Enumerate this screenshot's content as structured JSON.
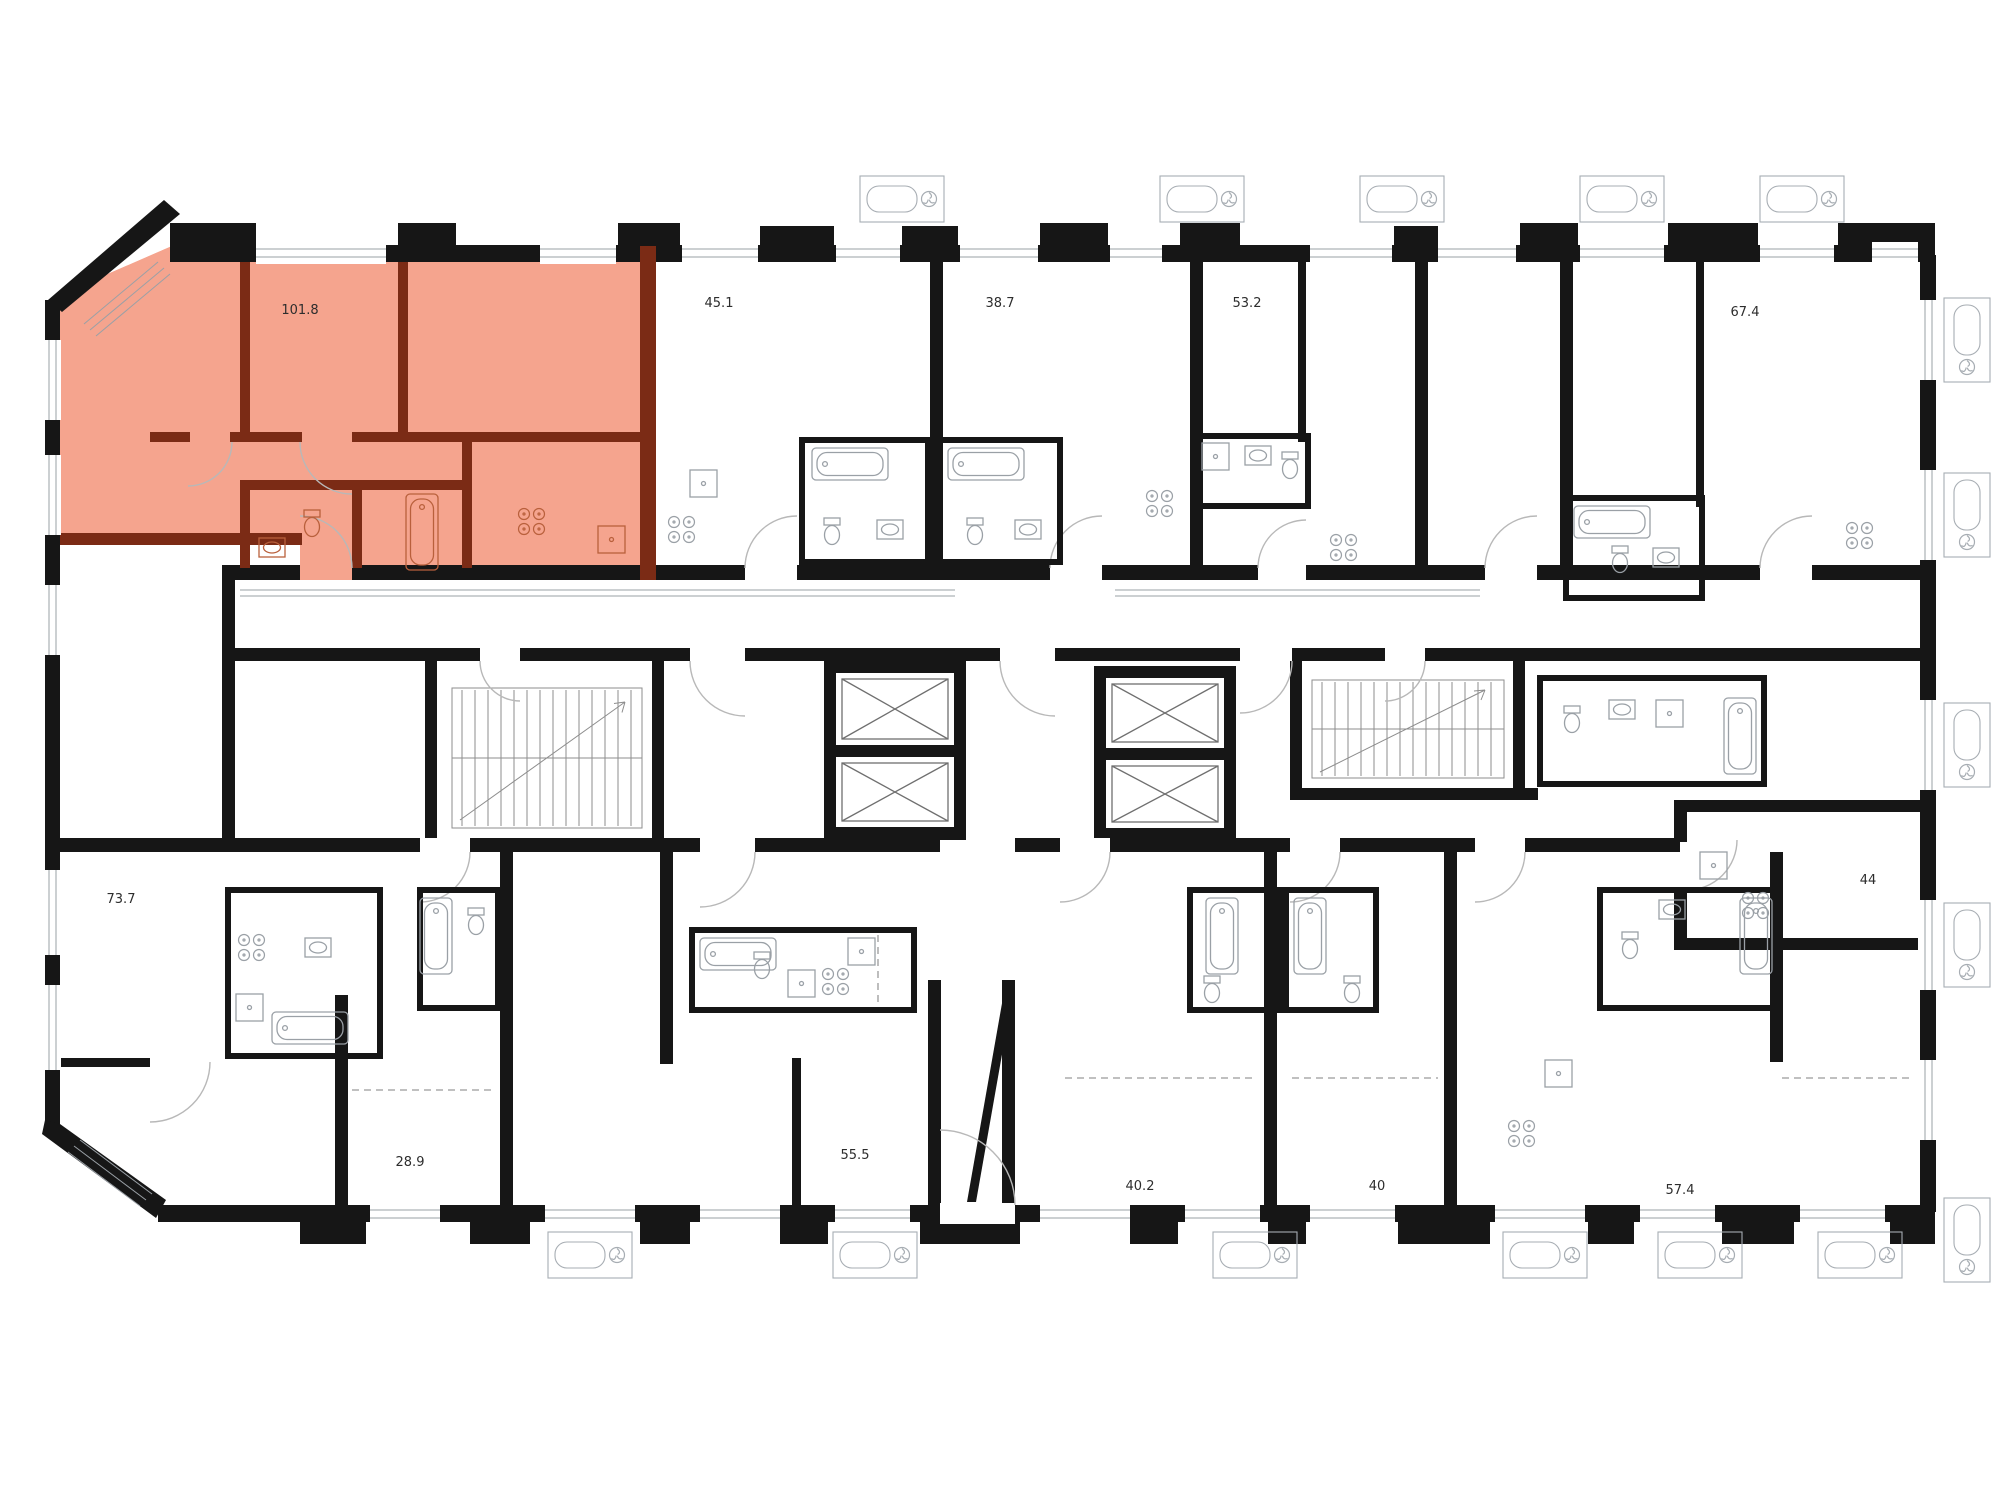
{
  "plan": {
    "type": "residential-floor-plan",
    "highlight": {
      "fill": "#f5a48e",
      "wall": "#7b2b15",
      "selected_unit_area": "101.8"
    },
    "colors": {
      "wall": "#161616",
      "fixture": "#9aa0a6",
      "background": "#ffffff"
    },
    "units": [
      {
        "id": "unit-101-8",
        "area": "101.8",
        "highlighted": true
      },
      {
        "id": "unit-45-1",
        "area": "45.1",
        "highlighted": false
      },
      {
        "id": "unit-38-7",
        "area": "38.7",
        "highlighted": false
      },
      {
        "id": "unit-53-2",
        "area": "53.2",
        "highlighted": false
      },
      {
        "id": "unit-67-4",
        "area": "67.4",
        "highlighted": false
      },
      {
        "id": "unit-73-7",
        "area": "73.7",
        "highlighted": false
      },
      {
        "id": "unit-44",
        "area": "44",
        "highlighted": false
      },
      {
        "id": "unit-28-9",
        "area": "28.9",
        "highlighted": false
      },
      {
        "id": "unit-55-5",
        "area": "55.5",
        "highlighted": false
      },
      {
        "id": "unit-40-2",
        "area": "40.2",
        "highlighted": false
      },
      {
        "id": "unit-40",
        "area": "40",
        "highlighted": false
      },
      {
        "id": "unit-57-4",
        "area": "57.4",
        "highlighted": false
      }
    ],
    "core": {
      "elevators": 4,
      "stairwells": 2
    }
  }
}
